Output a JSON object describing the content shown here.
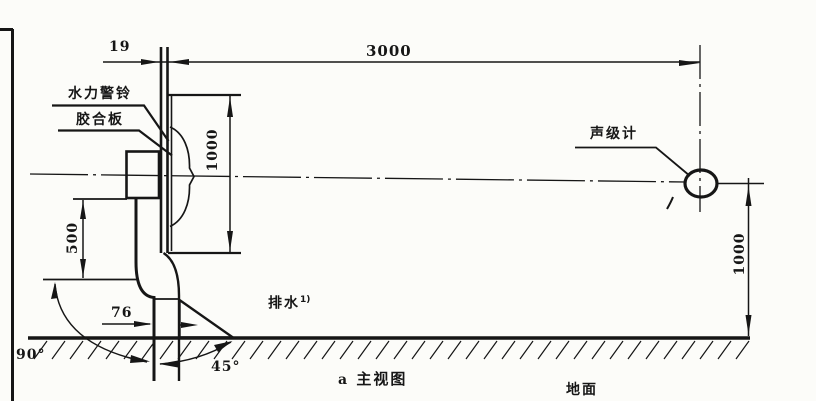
{
  "figure": {
    "caption_letter": "a",
    "caption": "主视图",
    "ink_color": "#161616",
    "paper_color": "#fcfcf9"
  },
  "labels": {
    "water_alarm_bell": "水力警铃",
    "plywood": "胶合板",
    "sound_level_meter": "声级计",
    "drain": "排水",
    "drain_note_ref": "1)",
    "ground": "地面"
  },
  "dimensions": {
    "board_thickness": "19",
    "meter_horizontal_distance": "3000",
    "bell_board_height": "1000",
    "outlet_drop": "500",
    "drain_pipe_size": "76",
    "meter_height_above_ground": "1000",
    "left_elbow_angle": "90°",
    "drain_cone_angle": "45°"
  }
}
